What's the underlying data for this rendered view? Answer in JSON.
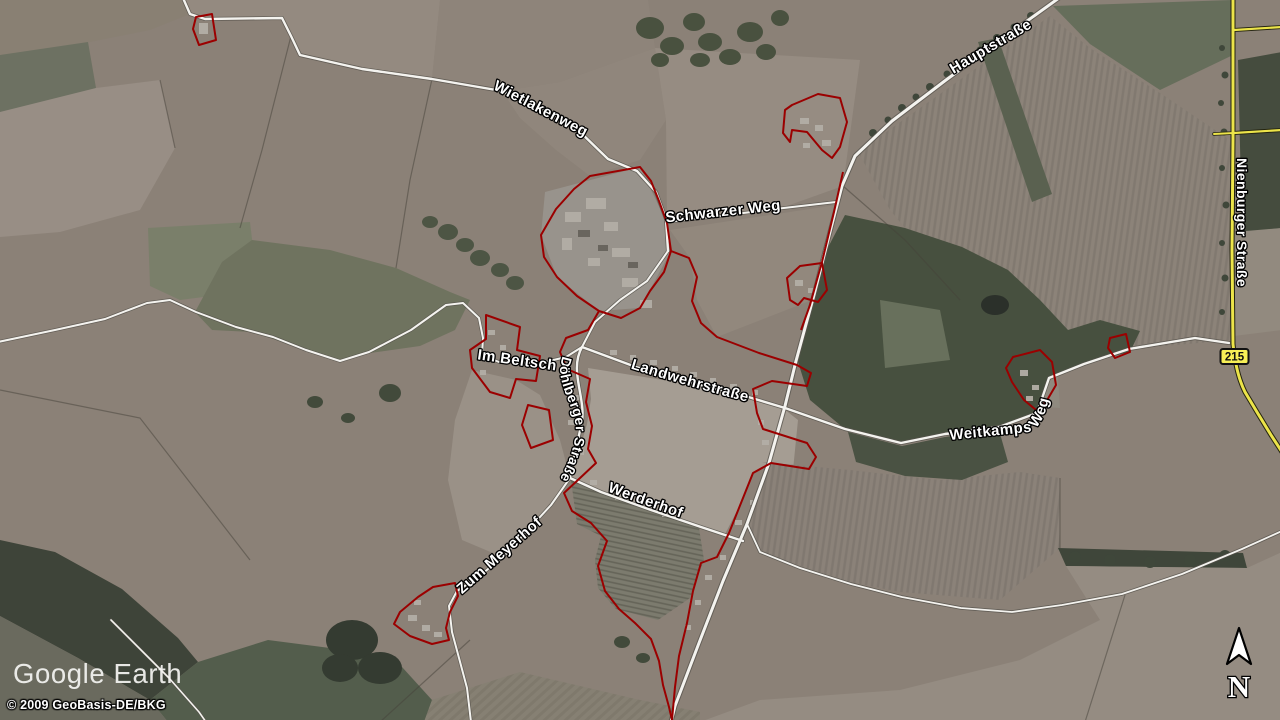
{
  "app": {
    "logo_text": "Google Earth",
    "attribution": "© 2009 GeoBasis-DE/BKG"
  },
  "map": {
    "road_labels": {
      "wietlakenweg": "Wietlakenweg",
      "schwarzer_weg": "Schwarzer Weg",
      "hauptstrasse": "Hauptstraße",
      "nienburger_strasse": "Nienburger Straße",
      "landwehrstrasse": "Landwehrstraße",
      "im_beltsch": "Im Beltsch",
      "doehlberger_strasse": "Döhlberger Straße",
      "werderhof": "Werderhof",
      "zum_meyerhof": "Zum Meyerhof",
      "weitkamps_weg": "Weitkamps Weg"
    },
    "route_badge": "215",
    "compass_north": "N",
    "colors": {
      "boundary_red": "#9b0000",
      "road_yellow": "#ece44a",
      "badge_yellow": "#f7ef56",
      "field_base": "#8b8177"
    }
  }
}
